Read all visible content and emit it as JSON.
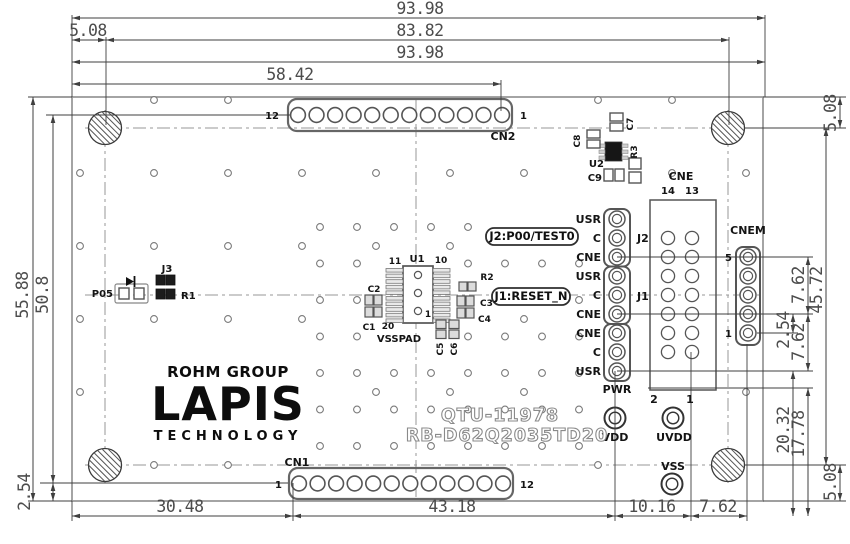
{
  "dims": {
    "w_total": "93.98",
    "m_left": "5.08",
    "w_holes": "83.82",
    "w_total2": "93.98",
    "w_cn2": "58.42",
    "h_total": "55.88",
    "h_rows": "50.8",
    "h_cn1": "2.54",
    "b1": "30.48",
    "b2": "43.18",
    "b3": "10.16",
    "b4": "7.62",
    "r_top": "5.08",
    "r_cnem_a": "7.62",
    "r_holes": "45.72",
    "r_pitch": "2.54",
    "r_cnem_b": "7.62",
    "r_a": "20.32",
    "r_b": "17.78",
    "r_bot": "5.08"
  },
  "connectors": {
    "cn2": {
      "name": "CN2",
      "left_pin": "12",
      "right_pin": "1"
    },
    "cn1": {
      "name": "CN1",
      "left_pin": "1",
      "right_pin": "12"
    },
    "cne": {
      "name": "CNE",
      "pin14": "14",
      "pin13": "13",
      "pin2": "2",
      "pin1": "1"
    },
    "cnem": {
      "name": "CNEM",
      "pin5": "5",
      "pin1": "1"
    },
    "j2": "J2",
    "j1": "J1",
    "pwr": "PWR",
    "row_labels": [
      "USR",
      "C",
      "CNE",
      "USR",
      "C",
      "CNE",
      "CNE",
      "C",
      "USR"
    ]
  },
  "pads": {
    "vdd": "VDD",
    "uvdd": "UVDD",
    "vss": "VSS"
  },
  "ic": {
    "u1": "U1",
    "pin11": "11",
    "pin10": "10",
    "pin20": "20",
    "pin1": "1",
    "u2": "U2"
  },
  "passives": {
    "c1": "C1",
    "c2": "C2",
    "c3": "C3",
    "c4": "C4",
    "c5": "C5",
    "c6": "C6",
    "c7": "C7",
    "c8": "C8",
    "c9": "C9",
    "r1": "R1",
    "r2": "R2",
    "r3": "R3",
    "j3": "J3",
    "p05": "P05",
    "vsspad": "VSSPAD"
  },
  "callouts": {
    "j2": "J2:P00/TEST0",
    "j1": "J1:RESET_N"
  },
  "branding": {
    "group": "ROHM GROUP",
    "name": "LAPIS",
    "sub": "TECHNOLOGY"
  },
  "board_ids": {
    "code": "QTU-11978",
    "part": "RB-D62Q2035TD20"
  }
}
